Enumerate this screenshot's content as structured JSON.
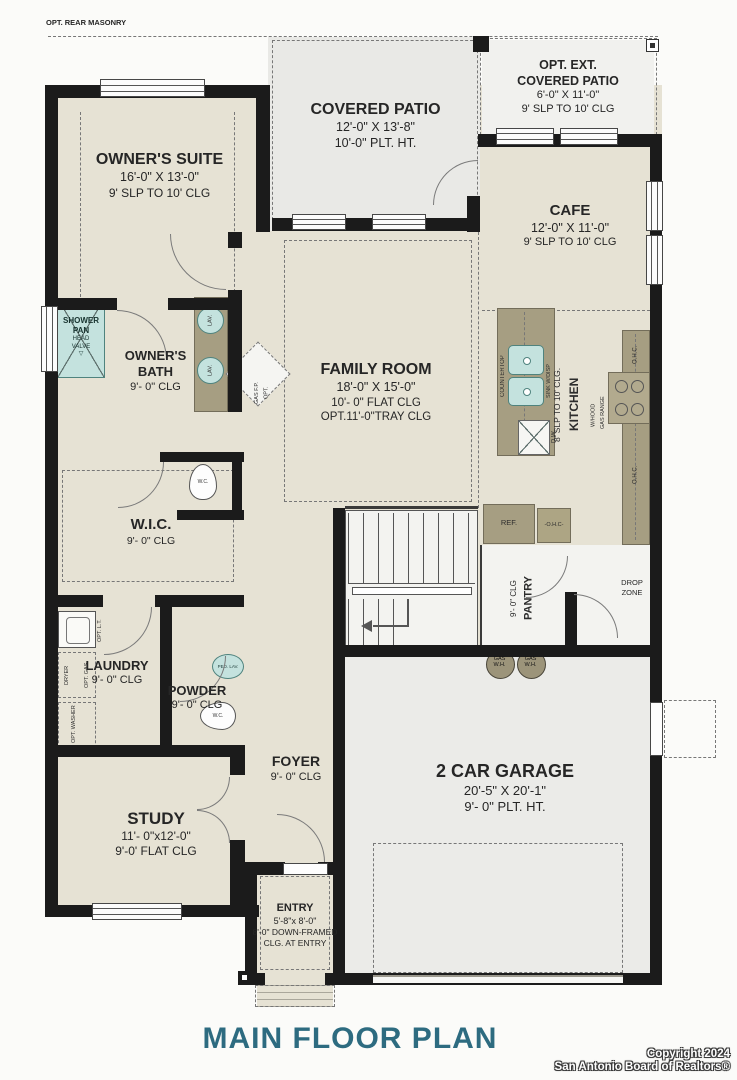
{
  "page": {
    "title": "MAIN FLOOR PLAN",
    "copyright1": "Copyright 2024",
    "copyright2": "San Antonio Board of Realtors®",
    "opt_rear_masonry": "OPT. REAR MASONRY"
  },
  "rooms": {
    "owners_suite": {
      "lines": [
        "OWNER'S SUITE",
        "16'-0\" X 13'-0\"",
        "9' SLP TO 10' CLG"
      ]
    },
    "covered_patio": {
      "lines": [
        "COVERED PATIO",
        "12'-0\" X 13'-8\"",
        "10'-0\" PLT. HT."
      ]
    },
    "opt_ext_patio": {
      "lines": [
        "OPT. EXT.",
        "COVERED PATIO",
        "6'-0\" X 11'-0\"",
        "9' SLP TO 10' CLG"
      ]
    },
    "cafe": {
      "lines": [
        "CAFE",
        "12'-0\" X 11'-0\"",
        "9' SLP TO 10' CLG"
      ]
    },
    "family_room": {
      "lines": [
        "FAMILY ROOM",
        "18'-0\" X 15'-0\"",
        "10'- 0\" FLAT CLG",
        "OPT.11'-0\"TRAY CLG"
      ]
    },
    "kitchen": {
      "lines": [
        "KITCHEN",
        "8' SLP TO 10' CLG."
      ]
    },
    "owners_bath": {
      "lines": [
        "OWNER'S",
        "BATH",
        "9'- 0\" CLG"
      ]
    },
    "wic": {
      "lines": [
        "W.I.C.",
        "9'- 0\" CLG"
      ]
    },
    "laundry": {
      "lines": [
        "LAUNDRY",
        "9'- 0\" CLG"
      ]
    },
    "powder": {
      "lines": [
        "POWDER",
        "9'- 0\" CLG"
      ]
    },
    "pantry": {
      "lines": [
        "PANTRY",
        "9'- 0\" CLG"
      ]
    },
    "drop_zone": {
      "lines": [
        "DROP",
        "ZONE"
      ]
    },
    "garage": {
      "lines": [
        "2 CAR GARAGE",
        "20'-5\" X 20'-1\"",
        "9'- 0\" PLT. HT."
      ]
    },
    "foyer": {
      "lines": [
        "FOYER",
        "9'- 0\" CLG"
      ]
    },
    "study": {
      "lines": [
        "STUDY",
        "11'- 0\"x12'-0\"",
        "9'-0' FLAT CLG"
      ]
    },
    "entry": {
      "lines": [
        "ENTRY",
        "5'-8\"x 8'-0\"",
        "8'-0\" DOWN-FRAMED",
        "CLG. AT ENTRY"
      ]
    }
  },
  "fixtures": {
    "shower": [
      "SHOWER",
      "PAN",
      "HEAD",
      "VALVE",
      "▽"
    ],
    "lav": "LAV.",
    "wc": "W.C.",
    "ped_lav": "PED. LAV.",
    "countertop": "COUNTERTOP",
    "sink": "SINK W/DISP",
    "dw": "D.W.",
    "gas_range": [
      "GAS RANGE",
      "W/HOOD"
    ],
    "ohc": "O.H.C.",
    "ohc_dash": "-O.H.C-",
    "ref": "REF.",
    "gas_wh": [
      "GAS",
      "W.H."
    ],
    "opt_lt": "OPT. L.T.",
    "dryer": "DRYER",
    "opt_gas": "OPT. GAS",
    "opt_washer": "OPT. WASHER",
    "opt_fp": [
      "OPT.",
      "GAS F.P."
    ]
  },
  "colors": {
    "title": "#2d6b80",
    "wall": "#1b1b1b",
    "floor": "#e6e2d4",
    "patio": "#e9e9e6",
    "counter": "#a69e82",
    "fixture_teal": "#c4e2de"
  }
}
